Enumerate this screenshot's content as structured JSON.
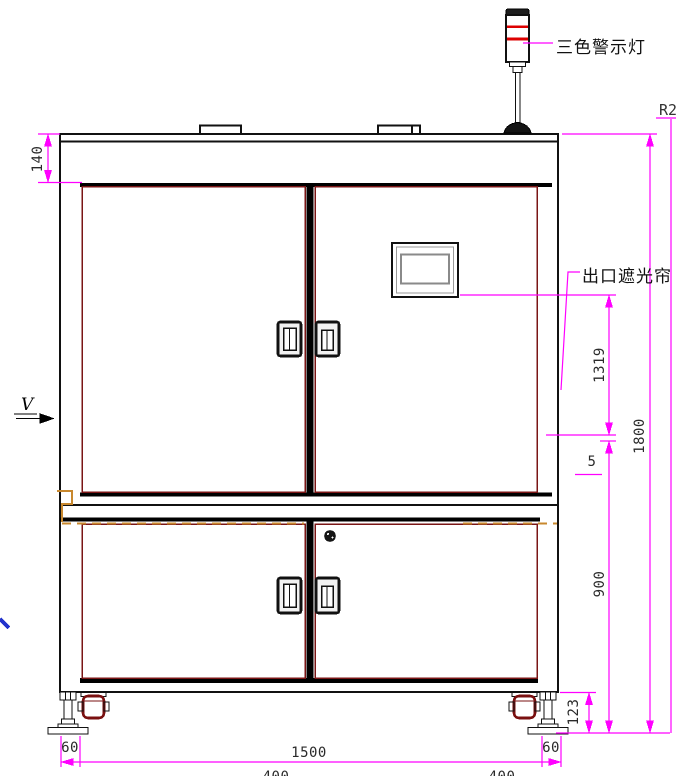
{
  "labels": {
    "tower_light": "三色警示灯",
    "light_curtain": "出口遮光帘",
    "view_marker": "V",
    "corner_ref": "R2"
  },
  "dimensions": {
    "top_frame_height": "140",
    "curtain_height": "1319",
    "overall_height": "1800",
    "gap": "5",
    "lower_section_height": "900",
    "caster_height": "123",
    "left_foot_width": "60",
    "right_foot_width": "60",
    "body_width": "1500",
    "left_span": "400",
    "right_span": "400"
  },
  "colors": {
    "dimension_line": "#ff00ff",
    "door_outline": "#7a1515",
    "frame_dashed": "#c8882e",
    "beacon_red": "#dd0000",
    "line_black": "#111111"
  }
}
